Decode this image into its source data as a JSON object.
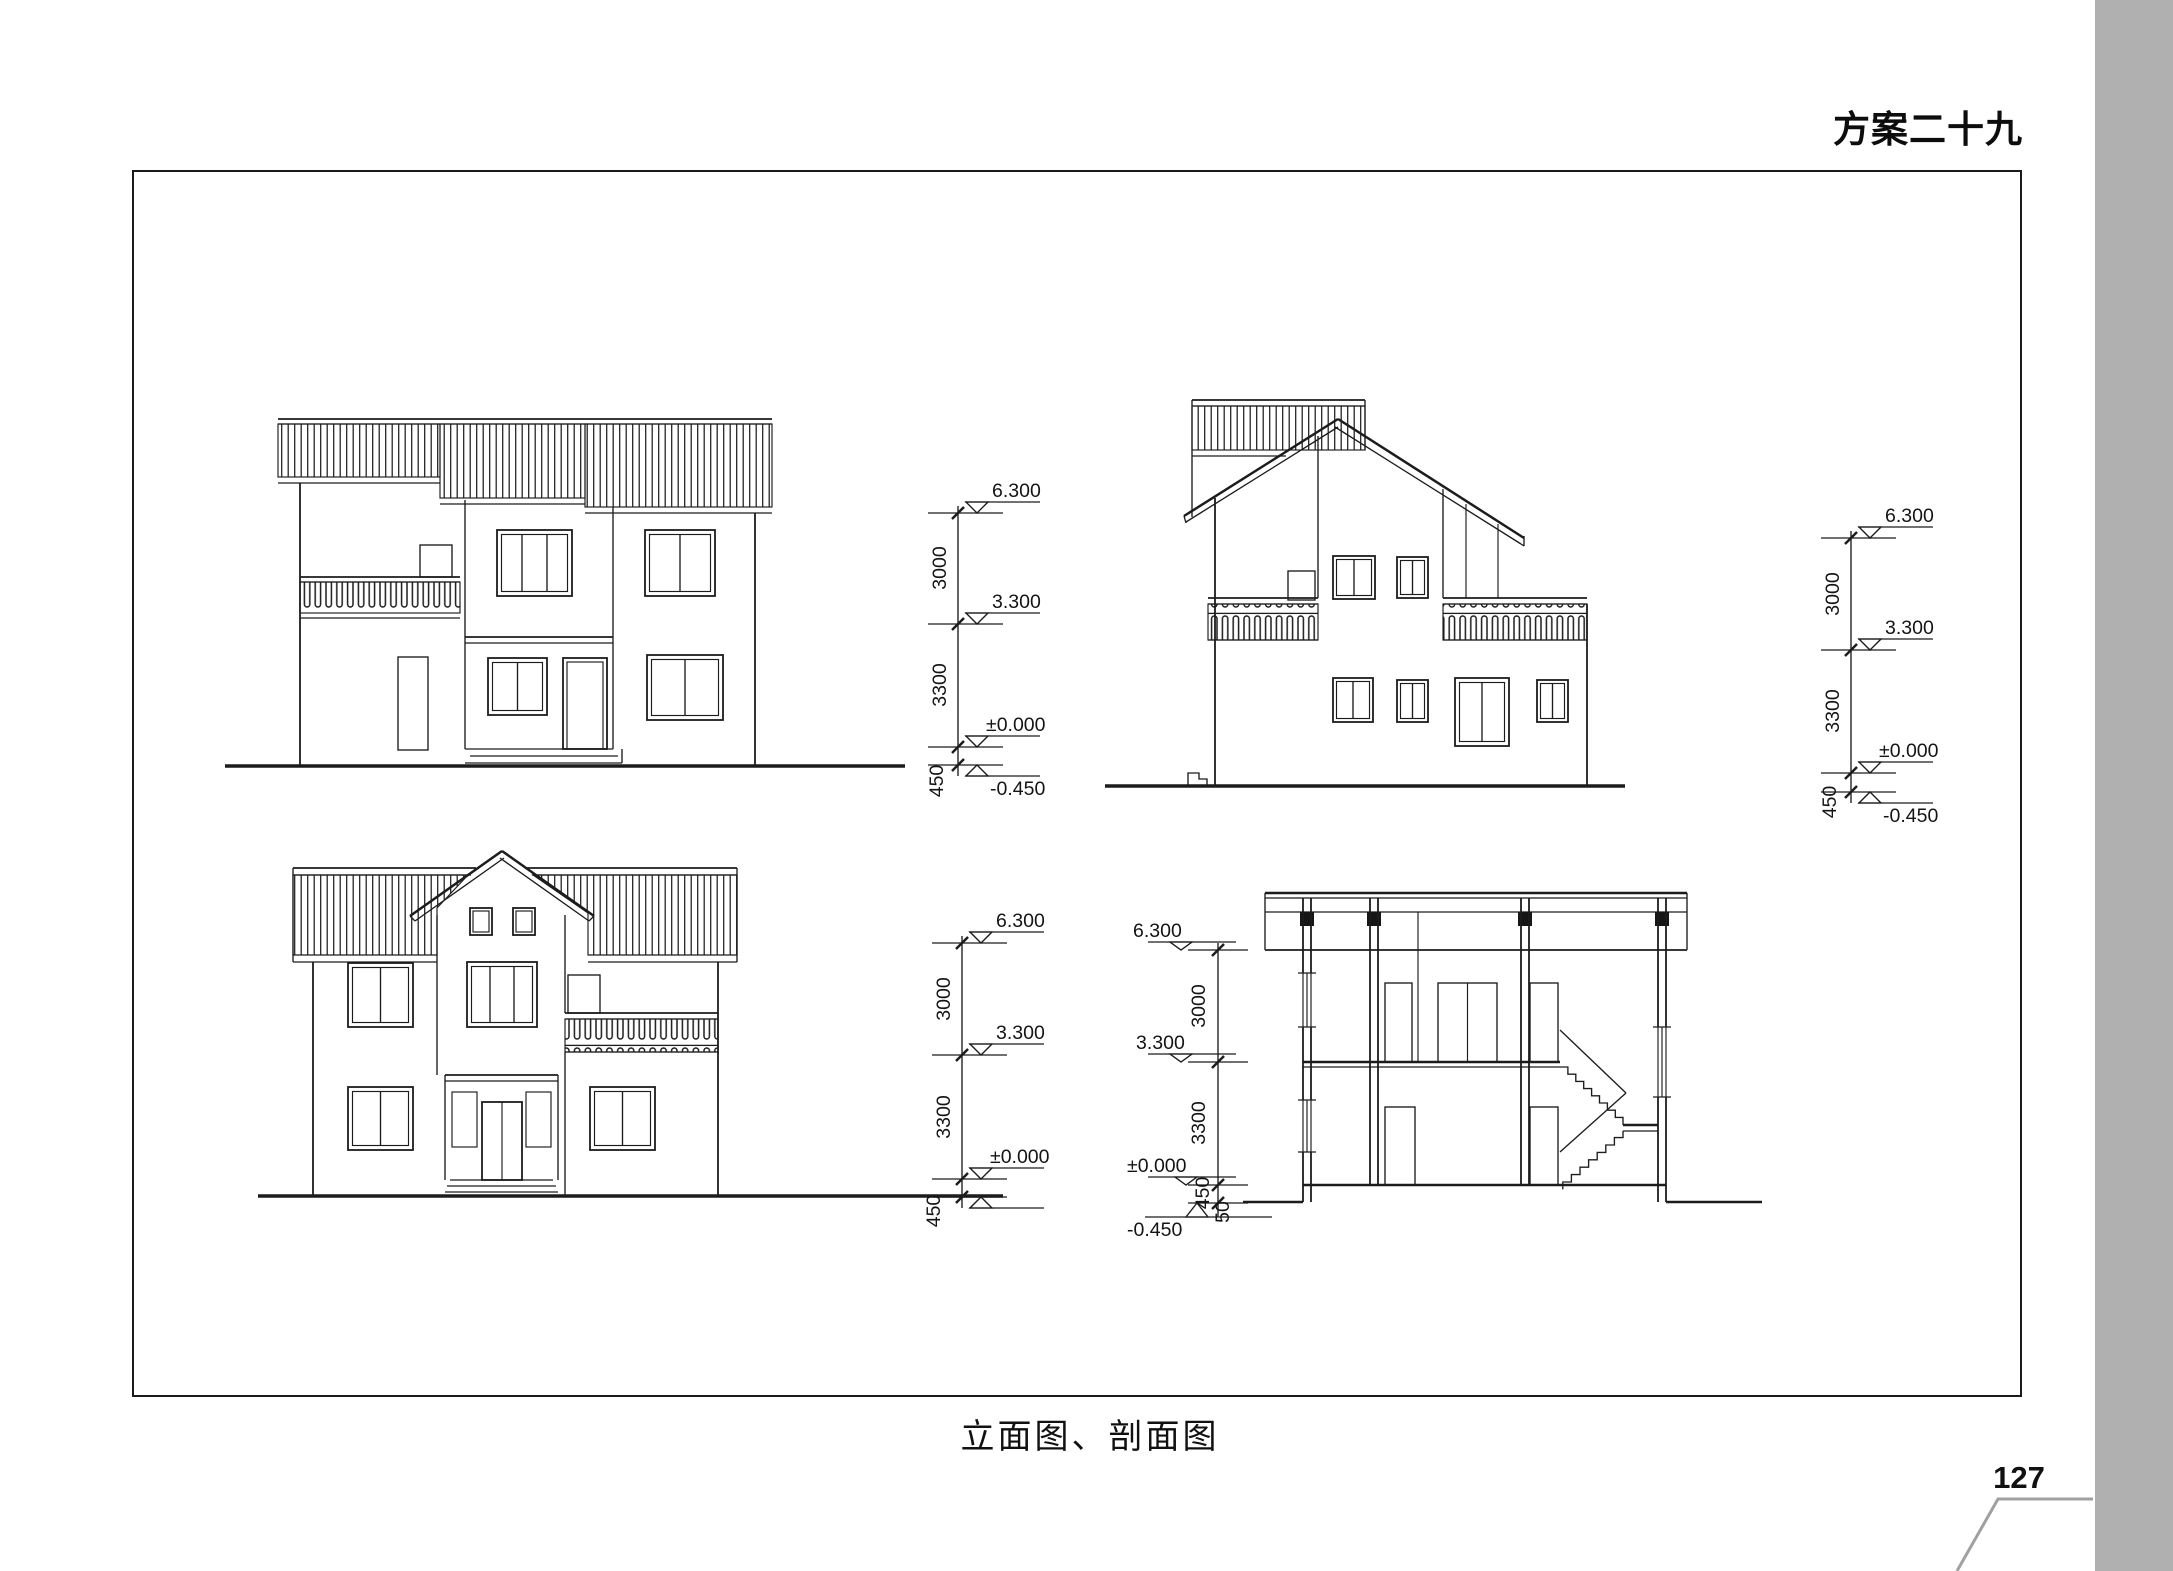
{
  "page": {
    "title": "方案二十九",
    "caption": "立面图、剖面图",
    "page_number": "127"
  },
  "dims": {
    "top_left": {
      "levels": [
        "6.300",
        "3.300",
        "±0.000",
        "-0.450"
      ],
      "segments": [
        "3000",
        "3300",
        "450"
      ]
    },
    "top_right": {
      "levels": [
        "6.300",
        "3.300",
        "±0.000",
        "-0.450"
      ],
      "segments": [
        "3000",
        "3300",
        "450"
      ]
    },
    "bottom_left": {
      "levels": [
        "6.300",
        "3.300",
        "±0.000"
      ],
      "segments": [
        "3000",
        "3300",
        "450"
      ]
    },
    "section": {
      "levels": [
        "6.300",
        "3.300",
        "±0.000",
        "-0.450"
      ],
      "segments": [
        "3000",
        "3300",
        "450",
        "50"
      ]
    }
  }
}
